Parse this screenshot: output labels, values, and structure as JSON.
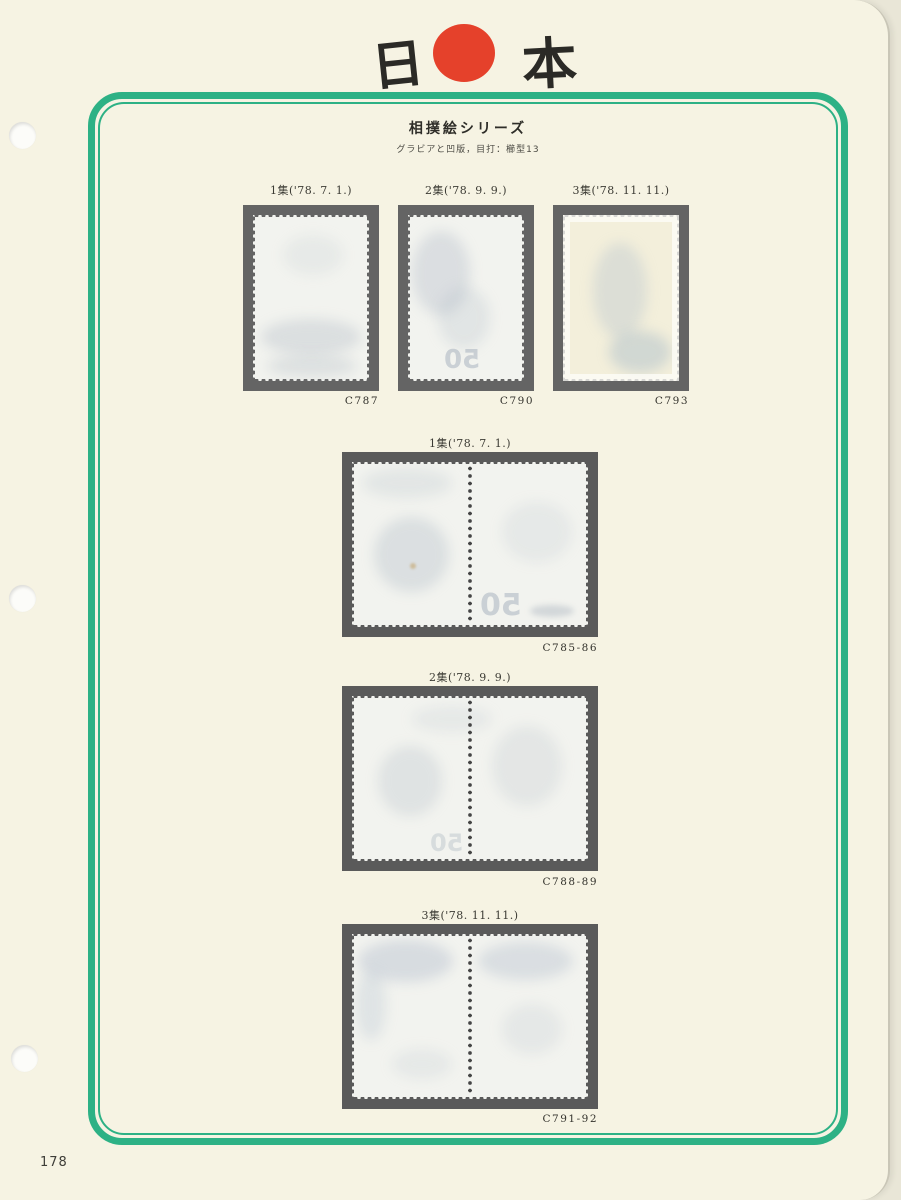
{
  "page": {
    "number": "178"
  },
  "header": {
    "logo_left": "日",
    "logo_right": "本"
  },
  "titles": {
    "title": "相撲絵シリーズ",
    "subtitle": "グラビアと凹版，目打：櫛型13"
  },
  "singles": [
    {
      "label": "1集('78. 7. 1.)",
      "catalog": "C787"
    },
    {
      "label": "2集('78. 9. 9.)",
      "catalog": "C790"
    },
    {
      "label": "3集('78. 11. 11.)",
      "catalog": "C793"
    }
  ],
  "pairs": [
    {
      "label": "1集('78. 7. 1.)",
      "catalog": "C785-86"
    },
    {
      "label": "2集('78. 9. 9.)",
      "catalog": "C788-89"
    },
    {
      "label": "3集('78. 11. 11.)",
      "catalog": "C791-92"
    }
  ],
  "ghost": {
    "value": "50"
  },
  "colors": {
    "paper": "#f6f3e3",
    "frame_green": "#2db185",
    "sun_red": "#e5412b",
    "mount_single": "#646464",
    "mount_pair": "#5a5a5a",
    "page_edge": "#c9c6b7"
  }
}
